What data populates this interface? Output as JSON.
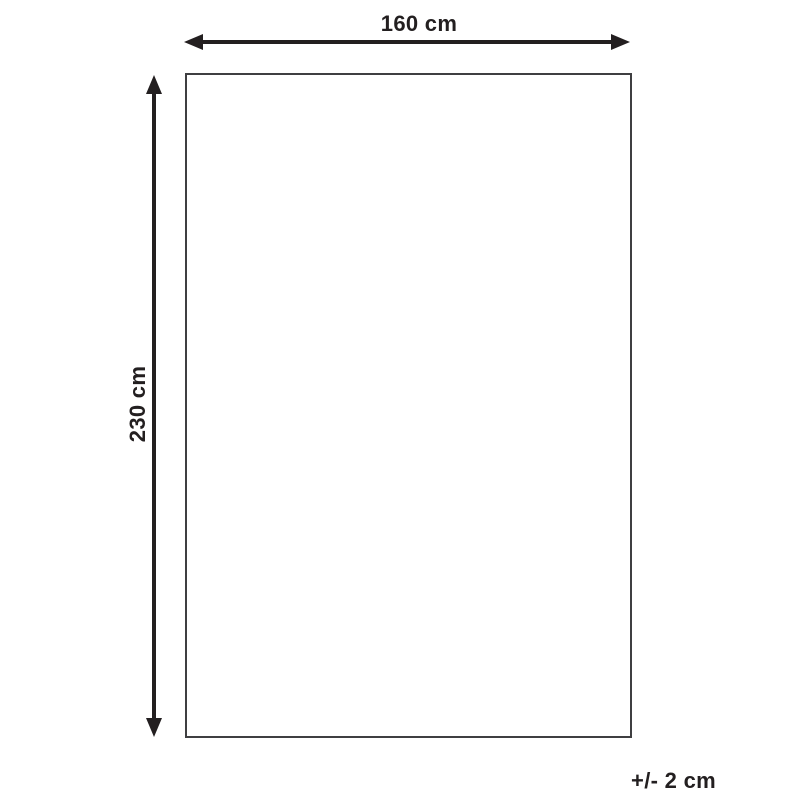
{
  "diagram": {
    "type": "product-dimension-diagram",
    "width_label": "160 cm",
    "height_label": "230 cm",
    "tolerance_label": "+/- 2 cm"
  },
  "colors": {
    "arrow": "#231f20",
    "text": "#231f20",
    "rect_border": "#3f3f41",
    "background": "#ffffff"
  }
}
